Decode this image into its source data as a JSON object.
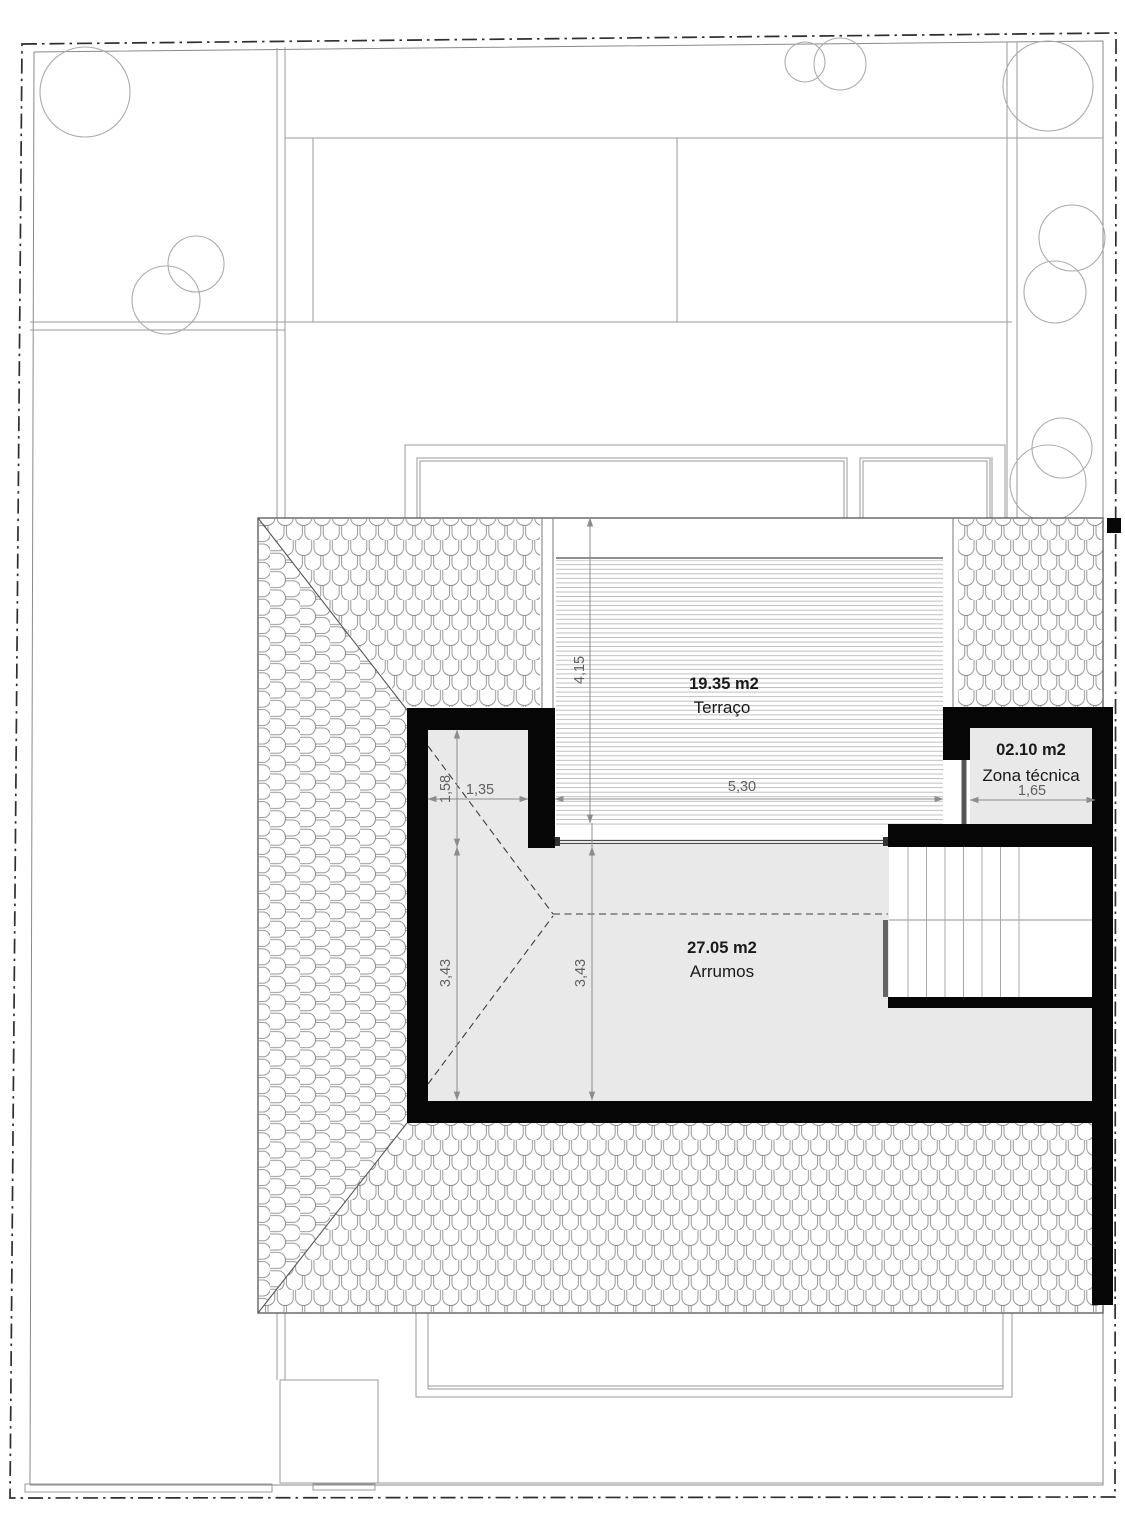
{
  "title": "Roof / attic floor plan",
  "rooms": {
    "terraco": {
      "area": "19.35 m2",
      "name": "Terraço"
    },
    "zona_tecnica": {
      "area": "02.10 m2",
      "name": "Zona técnica"
    },
    "arrumos": {
      "area": "27.05 m2",
      "name": "Arrumos"
    }
  },
  "dimensions": {
    "terrace_depth": "4,15",
    "terrace_width": "5,30",
    "alcove_width": "1,35",
    "alcove_depth": "1,58",
    "zona_tecnica_width": "1,65",
    "arrumos_depth_left": "3,43",
    "arrumos_depth_mid": "3,43"
  },
  "colors": {
    "wall": "#060606",
    "floor": "#e9e9e9",
    "line": "#9a9a9a",
    "tree": "#ababab",
    "dim": "#8c8c8c",
    "dimtext": "#5f5f5f",
    "text": "#1a1a1a",
    "boundary": "#2e2e2e",
    "tile": "#8d8d8d",
    "deck": "#b8b8b8"
  }
}
